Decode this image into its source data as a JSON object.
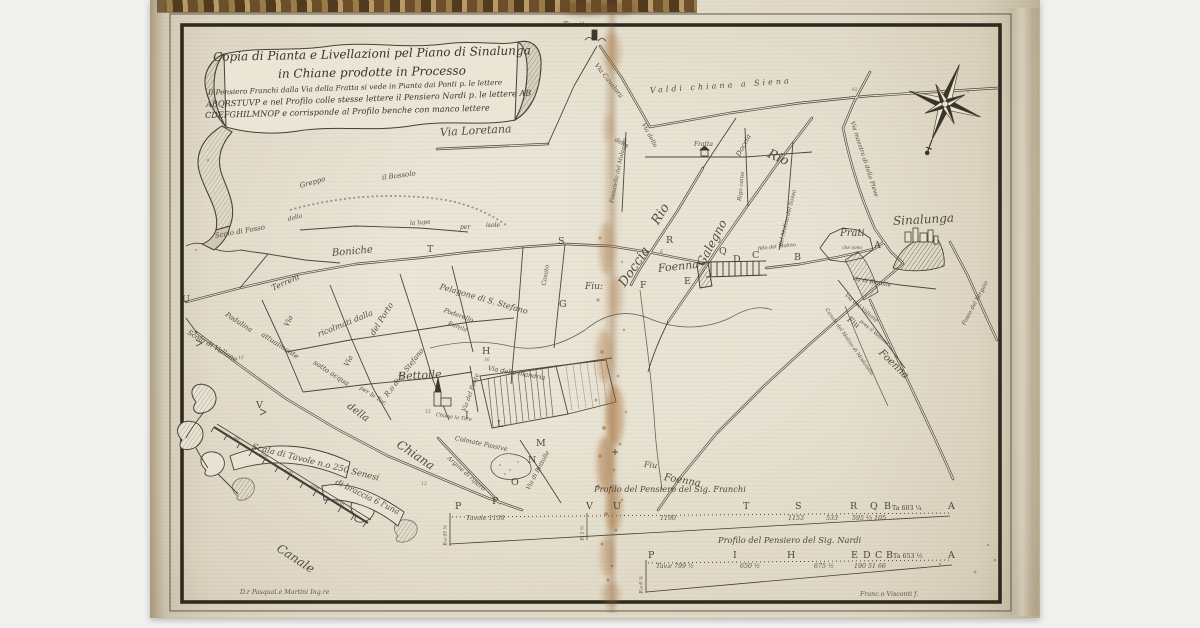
{
  "cartouche": {
    "line1": "Copia di Pianta e Livellazioni pel Piano di Sinalunga",
    "line2": "in Chiane prodotte in Processo",
    "line3": "Il Pensiero Franchi dalla Via della Fratta si vede in Pianta dai Ponti p. le lettere",
    "line4": "ABQRSTUVP e nel Profilo colle stesse lettere il Pensiero Nardi p. le lettere AB",
    "line5": "CDEFGHILMNOP e corrisponde al Profilo benche con manco lettere"
  },
  "icons": {
    "compass": "eight-point-compass-rose",
    "towns": [
      "Sinalunga hill town",
      "Bettolle church",
      "Torrita tower",
      "Fratta house",
      "Prati hamlet"
    ]
  },
  "map": {
    "labels": [
      {
        "t": "Via Loretana",
        "x": 440,
        "y": 126,
        "r": -3,
        "s": 11
      },
      {
        "t": "Torrita",
        "x": 563,
        "y": 20,
        "r": 0,
        "s": 7.5
      },
      {
        "t": "Via Cavalora",
        "x": 596,
        "y": 60,
        "r": 52,
        "s": 6.5
      },
      {
        "t": "Valdi chiana a Siena",
        "x": 650,
        "y": 86,
        "r": -4,
        "s": 8,
        "ls": 3
      },
      {
        "t": "della",
        "x": 615,
        "y": 136,
        "r": 28,
        "s": 6
      },
      {
        "t": "Via dello",
        "x": 643,
        "y": 120,
        "r": 62,
        "s": 6
      },
      {
        "t": "Fratta",
        "x": 694,
        "y": 141,
        "r": 0,
        "s": 6
      },
      {
        "t": "Fossatello del Molaggio",
        "x": 612,
        "y": 200,
        "r": -78,
        "s": 5.5
      },
      {
        "t": "Rigo caino",
        "x": 740,
        "y": 198,
        "r": -84,
        "s": 5.5
      },
      {
        "t": "Rio",
        "x": 768,
        "y": 146,
        "r": 24,
        "s": 13
      },
      {
        "t": "Rio",
        "x": 655,
        "y": 216,
        "r": -58,
        "s": 13
      },
      {
        "t": "Doccia",
        "x": 738,
        "y": 152,
        "r": -62,
        "s": 7
      },
      {
        "t": "Via maestra di della Pieve",
        "x": 852,
        "y": 118,
        "r": 72,
        "s": 6
      },
      {
        "t": "Galegno",
        "x": 700,
        "y": 258,
        "r": -62,
        "s": 12
      },
      {
        "t": "del Molino del Sasso",
        "x": 781,
        "y": 243,
        "r": -76,
        "s": 5.5
      },
      {
        "t": "Doccia",
        "x": 622,
        "y": 278,
        "r": -56,
        "s": 13
      },
      {
        "t": "Foenna",
        "x": 658,
        "y": 262,
        "r": -6,
        "s": 11
      },
      {
        "t": "Fiu:",
        "x": 585,
        "y": 282,
        "r": 0,
        "s": 9
      },
      {
        "t": "Sinalunga",
        "x": 893,
        "y": 214,
        "r": -3,
        "s": 12
      },
      {
        "t": "Prati",
        "x": 840,
        "y": 228,
        "r": 0,
        "s": 10
      },
      {
        "t": "che sono",
        "x": 842,
        "y": 246,
        "r": 0,
        "s": 4.5
      },
      {
        "t": "Via di Bettolle",
        "x": 852,
        "y": 276,
        "r": 10,
        "s": 5.5
      },
      {
        "t": "Via del Voltone",
        "x": 845,
        "y": 292,
        "r": 40,
        "s": 5.5
      },
      {
        "t": "pres il Voltone",
        "x": 860,
        "y": 318,
        "r": 40,
        "s": 5
      },
      {
        "t": "Fiu",
        "x": 848,
        "y": 314,
        "r": 35,
        "s": 8
      },
      {
        "t": "Foenna",
        "x": 880,
        "y": 346,
        "r": 44,
        "s": 10
      },
      {
        "t": "Canale del Molino di Modanella",
        "x": 826,
        "y": 306,
        "r": 55,
        "s": 5
      },
      {
        "t": "Fosso del Vergaio",
        "x": 964,
        "y": 322,
        "r": -62,
        "s": 5.5
      },
      {
        "t": "Scolo di Fosso",
        "x": 215,
        "y": 232,
        "r": -10,
        "s": 7
      },
      {
        "t": "Greppo",
        "x": 300,
        "y": 182,
        "r": -16,
        "s": 7
      },
      {
        "t": "della",
        "x": 288,
        "y": 216,
        "r": -14,
        "s": 6
      },
      {
        "t": "il Bossolo",
        "x": 382,
        "y": 174,
        "r": -8,
        "s": 7
      },
      {
        "t": "la lupa",
        "x": 410,
        "y": 220,
        "r": -4,
        "s": 6
      },
      {
        "t": "per",
        "x": 460,
        "y": 224,
        "r": 0,
        "s": 6
      },
      {
        "t": "isole",
        "x": 486,
        "y": 222,
        "r": 0,
        "s": 6
      },
      {
        "t": "Boniche",
        "x": 332,
        "y": 248,
        "r": -5,
        "s": 10
      },
      {
        "t": "Terreni",
        "x": 272,
        "y": 284,
        "r": -24,
        "s": 8
      },
      {
        "t": "ricolmati dalla",
        "x": 318,
        "y": 330,
        "r": -22,
        "s": 8
      },
      {
        "t": "Via",
        "x": 286,
        "y": 322,
        "r": -62,
        "s": 7
      },
      {
        "t": "Via",
        "x": 346,
        "y": 362,
        "r": -62,
        "s": 7
      },
      {
        "t": "del Porto",
        "x": 372,
        "y": 330,
        "r": -58,
        "s": 8
      },
      {
        "t": "R.o di S. Stefano",
        "x": 386,
        "y": 392,
        "r": -52,
        "s": 7
      },
      {
        "t": "Pelagone di S. Stefano",
        "x": 440,
        "y": 282,
        "r": 16,
        "s": 8
      },
      {
        "t": "Poderello",
        "x": 444,
        "y": 306,
        "r": 20,
        "s": 6.5
      },
      {
        "t": "Eurela",
        "x": 448,
        "y": 320,
        "r": 20,
        "s": 6
      },
      {
        "t": "Casato",
        "x": 544,
        "y": 282,
        "r": -80,
        "s": 6
      },
      {
        "t": "Scolo di Vallone",
        "x": 188,
        "y": 328,
        "r": 30,
        "s": 7
      },
      {
        "t": "Padulina",
        "x": 226,
        "y": 310,
        "r": 33,
        "s": 7
      },
      {
        "t": "attualmente",
        "x": 262,
        "y": 330,
        "r": 33,
        "s": 7
      },
      {
        "t": "sotto acqua",
        "x": 314,
        "y": 358,
        "r": 33,
        "s": 7
      },
      {
        "t": "per le Tor.",
        "x": 360,
        "y": 384,
        "r": 33,
        "s": 6
      },
      {
        "t": "Canale",
        "x": 278,
        "y": 540,
        "r": 33,
        "s": 12
      },
      {
        "t": "della",
        "x": 348,
        "y": 400,
        "r": 36,
        "s": 10
      },
      {
        "t": "Chiana",
        "x": 398,
        "y": 436,
        "r": 34,
        "s": 12
      },
      {
        "t": "Bettolle",
        "x": 398,
        "y": 370,
        "r": -3,
        "s": 11
      },
      {
        "t": "Via della mandria",
        "x": 488,
        "y": 364,
        "r": 10,
        "s": 6.5
      },
      {
        "t": "Via del Ponte",
        "x": 464,
        "y": 408,
        "r": -70,
        "s": 6
      },
      {
        "t": "Chiesa la Tore",
        "x": 436,
        "y": 412,
        "r": 8,
        "s": 5
      },
      {
        "t": "Colmate Passive",
        "x": 455,
        "y": 434,
        "r": 12,
        "s": 6.5
      },
      {
        "t": "Argine di riparo",
        "x": 448,
        "y": 454,
        "r": 42,
        "s": 6
      },
      {
        "t": "Via di Bettolle",
        "x": 528,
        "y": 486,
        "r": -62,
        "s": 6
      },
      {
        "t": "Fiu",
        "x": 644,
        "y": 460,
        "r": 5,
        "s": 8
      },
      {
        "t": "Foenna",
        "x": 664,
        "y": 472,
        "r": 10,
        "s": 10
      },
      {
        "t": "fido del Molino",
        "x": 758,
        "y": 246,
        "r": -6,
        "s": 5
      }
    ],
    "route_letters": [
      {
        "t": "A",
        "x": 874,
        "y": 240
      },
      {
        "t": "B",
        "x": 794,
        "y": 252
      },
      {
        "t": "Q",
        "x": 719,
        "y": 246
      },
      {
        "t": "R",
        "x": 666,
        "y": 235
      },
      {
        "t": "S",
        "x": 558,
        "y": 236
      },
      {
        "t": "T",
        "x": 427,
        "y": 244
      },
      {
        "t": "U",
        "x": 182,
        "y": 294
      },
      {
        "t": "V",
        "x": 256,
        "y": 400
      },
      {
        "t": "P",
        "x": 492,
        "y": 496
      },
      {
        "t": "C",
        "x": 752,
        "y": 250
      },
      {
        "t": "D",
        "x": 733,
        "y": 254
      },
      {
        "t": "E",
        "x": 684,
        "y": 276
      },
      {
        "t": "F",
        "x": 640,
        "y": 280
      },
      {
        "t": "G",
        "x": 559,
        "y": 299
      },
      {
        "t": "H",
        "x": 482,
        "y": 346
      },
      {
        "t": "I",
        "x": 465,
        "y": 410
      },
      {
        "t": "L",
        "x": 497,
        "y": 419
      },
      {
        "t": "M",
        "x": 536,
        "y": 438
      },
      {
        "t": "N",
        "x": 528,
        "y": 455
      },
      {
        "t": "O",
        "x": 511,
        "y": 477
      }
    ],
    "parcel_numbers": [
      {
        "t": "16",
        "x": 484,
        "y": 358
      },
      {
        "t": "15",
        "x": 425,
        "y": 410
      },
      {
        "t": "13",
        "x": 421,
        "y": 482
      },
      {
        "t": "15",
        "x": 238,
        "y": 356
      },
      {
        "t": "6",
        "x": 660,
        "y": 250
      },
      {
        "t": "62",
        "x": 852,
        "y": 88
      }
    ]
  },
  "scale": {
    "text1": "Scala di Tavole n.o 250 Senesi",
    "text2": "di braccia 6 l'una",
    "ticks": [
      {
        "t": "50",
        "x": 234,
        "y": 435
      },
      {
        "t": "100",
        "x": 260,
        "y": 451
      },
      {
        "t": "150",
        "x": 285,
        "y": 467
      },
      {
        "t": "200",
        "x": 311,
        "y": 483
      },
      {
        "t": "250",
        "x": 336,
        "y": 499
      }
    ]
  },
  "profiles": {
    "franchi": {
      "title": "Profilo del Pensiero del Sig. Franchi",
      "letters": [
        {
          "t": "P",
          "x": 455
        },
        {
          "t": "V",
          "x": 586
        },
        {
          "t": "U",
          "x": 613
        },
        {
          "t": "T",
          "x": 743
        },
        {
          "t": "S",
          "x": 795
        },
        {
          "t": "R",
          "x": 850
        },
        {
          "t": "Q",
          "x": 870
        },
        {
          "t": "B",
          "x": 884
        },
        {
          "t": "Ta 603 ¼",
          "x": 892,
          "y": 505,
          "s": 6.3
        },
        {
          "t": "A",
          "x": 948
        }
      ],
      "numbers": [
        {
          "t": "Tavole 1159",
          "x": 466
        },
        {
          "t": "1190",
          "x": 660
        },
        {
          "t": "1153",
          "x": 788
        },
        {
          "t": "533",
          "x": 826
        },
        {
          "t": "595 ⅔ 105",
          "x": 852
        }
      ],
      "notes": [
        {
          "t": "B.a 45 ⅚",
          "x": 446,
          "y": 543
        },
        {
          "t": "B. 2 ⅖",
          "x": 583,
          "y": 538
        }
      ]
    },
    "nardi": {
      "title": "Profilo del Pensiero del Sig. Nardi",
      "letters": [
        {
          "t": "P",
          "x": 648
        },
        {
          "t": "I",
          "x": 733
        },
        {
          "t": "H",
          "x": 787
        },
        {
          "t": "E",
          "x": 851
        },
        {
          "t": "D",
          "x": 863
        },
        {
          "t": "C",
          "x": 875
        },
        {
          "t": "B",
          "x": 886
        },
        {
          "t": "Ta 653 ½",
          "x": 893,
          "y": 553,
          "s": 6.3
        },
        {
          "t": "A",
          "x": 948
        }
      ],
      "numbers": [
        {
          "t": "Tav.e 799 ½",
          "x": 656
        },
        {
          "t": "650 ½",
          "x": 740
        },
        {
          "t": "675 ½",
          "x": 814
        },
        {
          "t": "190 51 66",
          "x": 854
        }
      ],
      "notes": [
        {
          "t": "B.a 6 ⅚",
          "x": 642,
          "y": 591
        }
      ]
    }
  },
  "signatures": {
    "engineer": "D.r Pasqual.e Martini Ing.re",
    "engraver": "Franc.o Visconti f."
  },
  "colors": {
    "paper": "#e6e0d0",
    "ink": "#3e382c",
    "frame": "#2f2a20",
    "stain": "#a2672e",
    "book_edge": "#241b10"
  }
}
